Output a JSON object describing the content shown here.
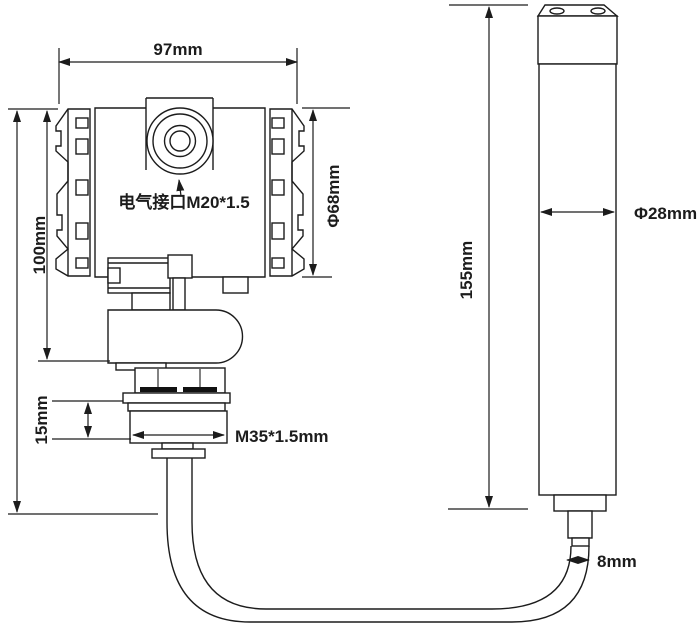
{
  "drawing_title": "pressure-level-transmitter-dimension-drawing",
  "colors": {
    "line": "#1c1c1c",
    "background": "#ffffff",
    "seal": "#111111"
  },
  "labels": {
    "housing_width": "97mm",
    "housing_height": "100mm",
    "housing_diameter": "Φ68mm",
    "electrical_interface": "电气接口M20*1.5",
    "thread_height": "15mm",
    "mounting_thread": "M35*1.5mm",
    "probe_length": "155mm",
    "probe_diameter": "Φ28mm",
    "cable_diameter": "8mm"
  }
}
